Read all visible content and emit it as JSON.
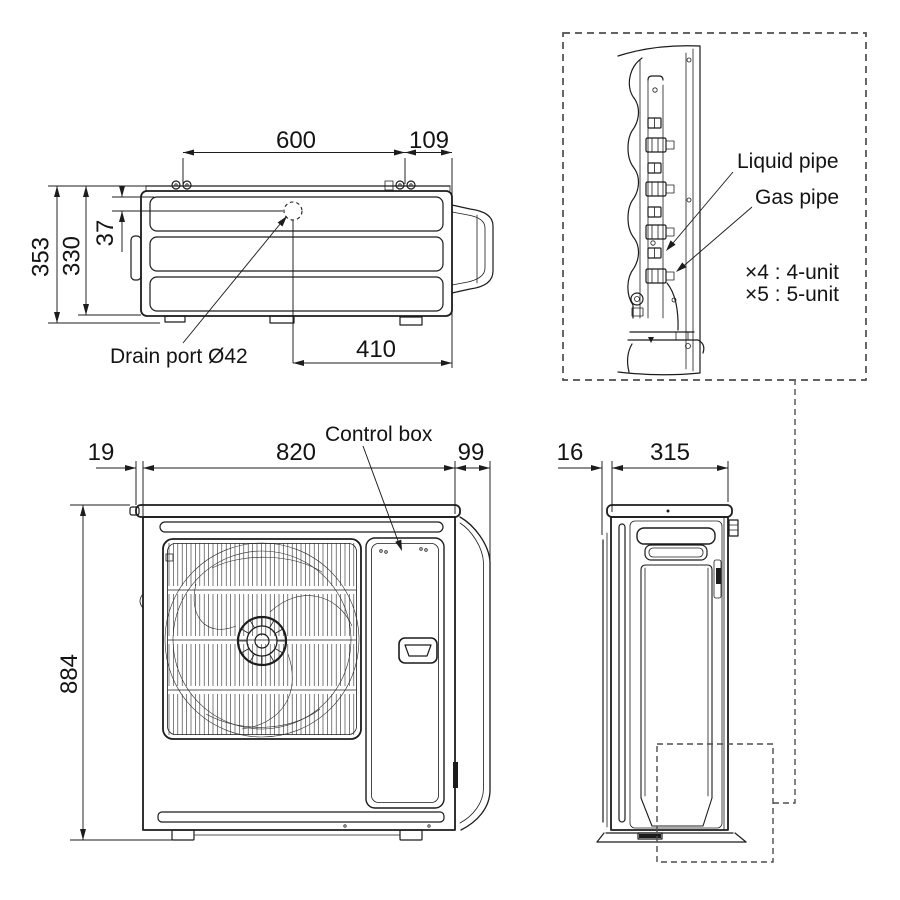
{
  "drawing_title": "outdoor-unit-dimension-drawing",
  "views": {
    "top": {
      "dim_width": "600",
      "dim_offset_right": "109",
      "dim_depth_total": "353",
      "dim_depth_body": "330",
      "dim_drain_offset": "37",
      "dim_drain_from_right": "410",
      "drain_label": "Drain port Ø42"
    },
    "pipe_detail": {
      "liquid_label": "Liquid pipe",
      "gas_label": "Gas pipe",
      "note_line1": "×4 : 4-unit",
      "note_line2": "×5 : 5-unit"
    },
    "front": {
      "control_box_label": "Control box",
      "dim_left_margin": "19",
      "dim_width": "820",
      "dim_right_margin": "99",
      "dim_height": "884"
    },
    "side": {
      "dim_back_margin": "16",
      "dim_depth": "315"
    }
  },
  "colors": {
    "line": "#1c1c1c",
    "detail_frame_dash": "#4d4d4d",
    "background": "#ffffff"
  }
}
